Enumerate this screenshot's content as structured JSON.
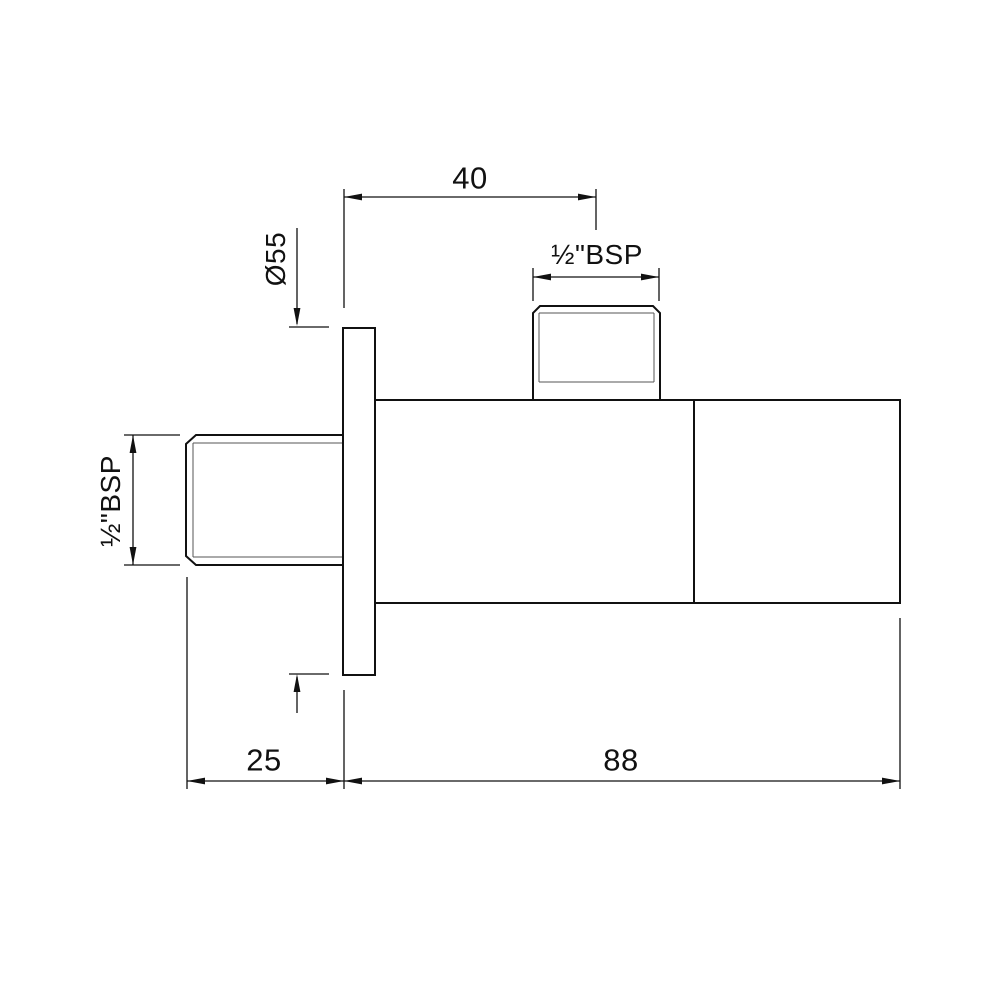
{
  "drawing": {
    "background_color": "#ffffff",
    "line_color": "#111111",
    "thread_line_color": "#555555",
    "view": "side-elevation-with-dimensions",
    "labels": {
      "horizontal_offset": "40",
      "flange_diameter": "Ø55",
      "outlet_thread": "½\"BSP",
      "inlet_thread": "½\"BSP",
      "wall_offset": "25",
      "body_length": "88"
    }
  }
}
